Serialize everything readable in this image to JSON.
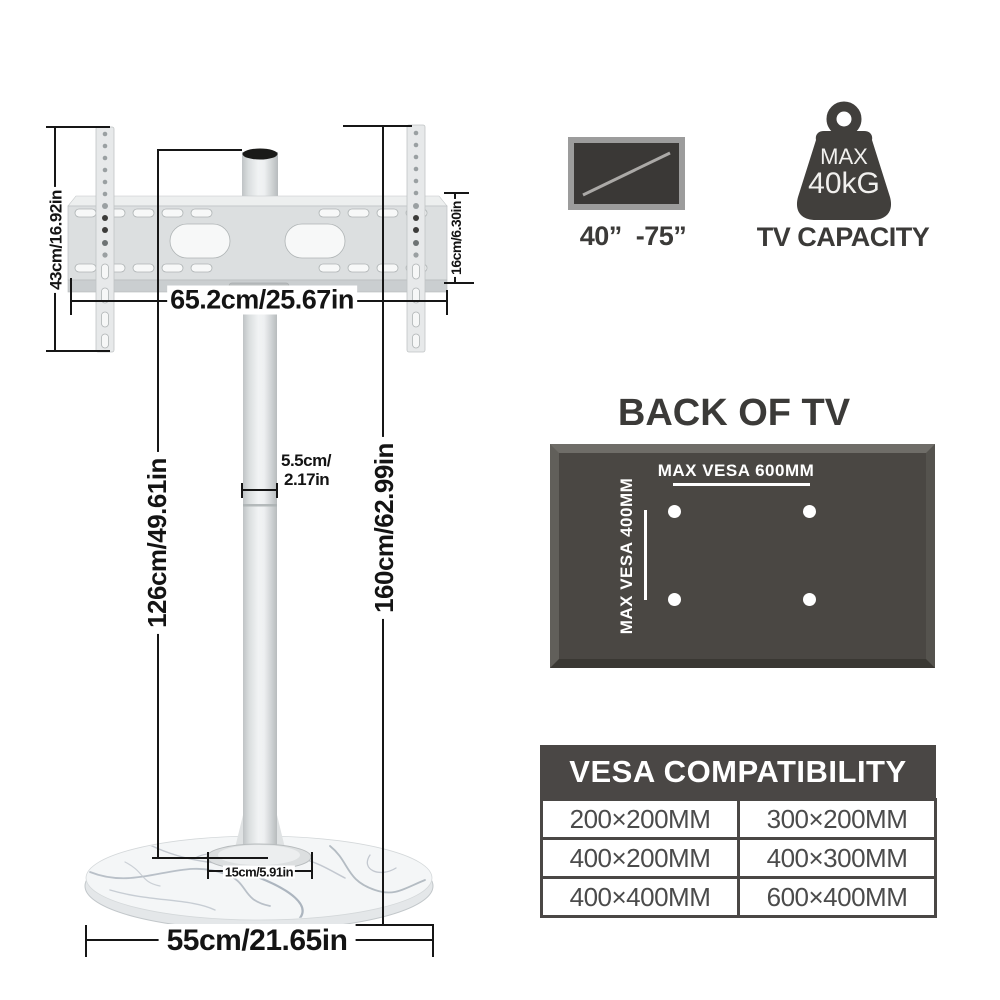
{
  "diagram": {
    "dims": {
      "bracket_height": "43cm/16.92in",
      "bracket_width": "65.2cm/25.67in",
      "bracket_depth": "16cm/6.30in",
      "pole_height": "126cm/49.61in",
      "total_height": "160cm/62.99in",
      "pole_diameter_line1": "5.5cm/",
      "pole_diameter_line2": "2.17in",
      "base_collar_width": "15cm/5.91in",
      "base_width": "55cm/21.65in"
    }
  },
  "specs": {
    "tv_size": "40”  -75”",
    "weight_max_label": "MAX",
    "weight_value": "40kG",
    "capacity_label": "TV CAPACITY"
  },
  "back_of_tv": {
    "title": "BACK OF TV",
    "max_vesa_horizontal": "MAX VESA 600MM",
    "max_vesa_vertical": "MAX VESA 400MM"
  },
  "vesa": {
    "title": "VESA COMPATIBILITY",
    "rows": [
      [
        "200×200MM",
        "300×200MM"
      ],
      [
        "400×200MM",
        "400×300MM"
      ],
      [
        "400×400MM",
        "600×400MM"
      ]
    ]
  },
  "colors": {
    "dark": "#4a4745",
    "text_dark": "#3b3a38",
    "panel_face": "#4a4743",
    "line": "#161616"
  }
}
